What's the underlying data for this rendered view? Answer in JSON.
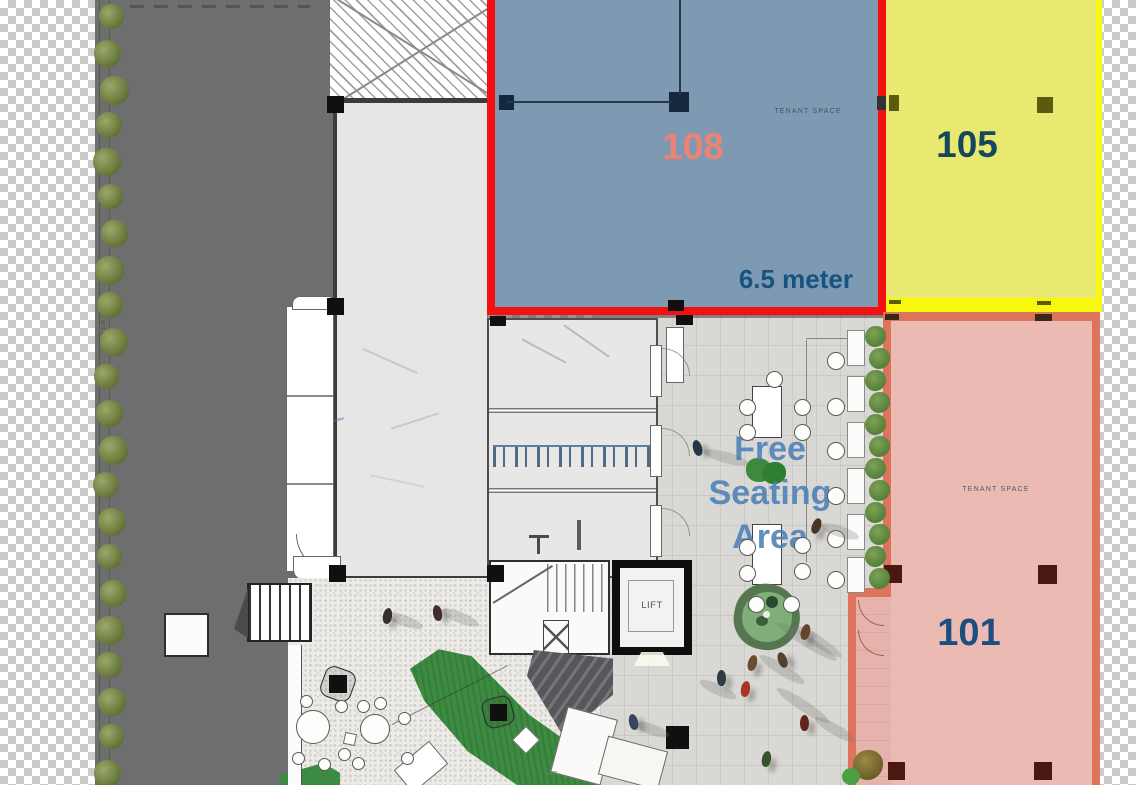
{
  "plan_title": "ground-floor-leasing-plan",
  "background": {
    "checker_light": "#ffffff",
    "checker_dark": "#cbcbcb",
    "road_color": "#6e6e6e",
    "pavement_color": "#d9d8d4",
    "terrace_color": "#ecebe7",
    "grass_color": "#3d8a42"
  },
  "spaces": {
    "s108": {
      "number": "108",
      "tenant_label": "TENANT SPACE",
      "dimension": "6.5 meter",
      "fill": "#7d9ab2",
      "border": "#f51010",
      "number_color": "#ed8372",
      "dimension_color": "#175380"
    },
    "s105": {
      "number": "105",
      "fill": "#e9e972",
      "border": "#f8f80c",
      "number_color": "#16485c"
    },
    "s101": {
      "number": "101",
      "tenant_label": "TENANT SPACE",
      "fill": "#ebbab3",
      "border": "#df745c",
      "number_color": "#1d4e80"
    }
  },
  "plaza": {
    "seating_line1": "Free",
    "seating_line2": "Seating",
    "seating_line3": "Area",
    "text_color": "#4b80b8"
  },
  "lift": {
    "label": "LIFT"
  },
  "lift_small": {
    "label": "LIFT"
  },
  "green_wall": {
    "label": "GREEN WALL"
  }
}
